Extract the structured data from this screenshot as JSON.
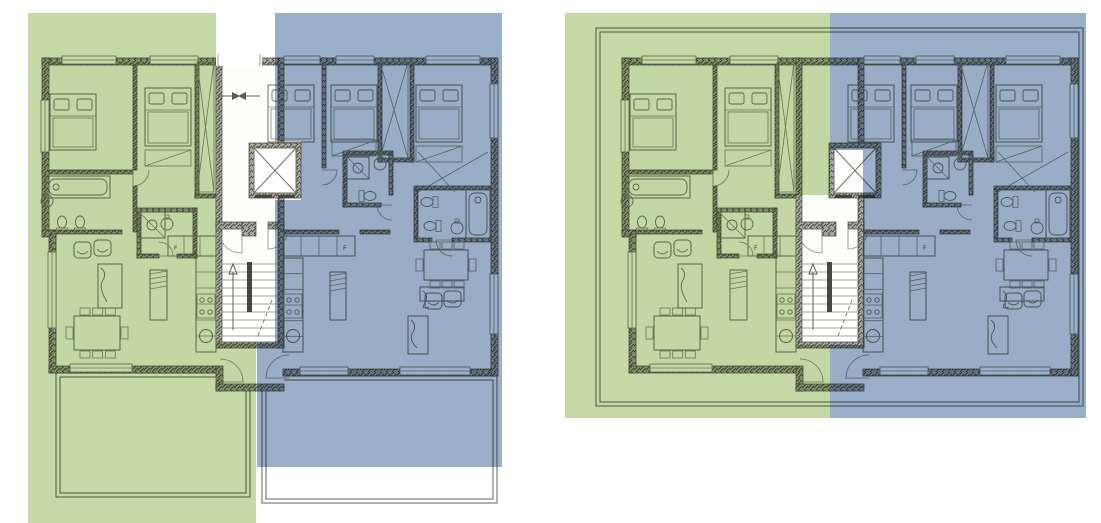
{
  "meta": {
    "description": "Two apartment floor plans side by side: ground floor with garden terraces and upper floor with roof outline. Each plan split into a green unit (left) and a blue unit (right) around a central stair and elevator core.",
    "canvas": {
      "w": 1101,
      "h": 523
    }
  },
  "colors": {
    "unit_a_green": "#c5d9a6",
    "unit_b_blue": "#9aafc9",
    "paper": "#ffffff",
    "floor_fill": "#fdfdfc",
    "wall_hatch_bg": "#b2b2ab",
    "wall_hatch_line": "#51534c",
    "wall_stroke": "#45473f",
    "line": "#71756a",
    "thin_line": "#868a7e",
    "outline": "#62665b",
    "arrow": "#5a5d53"
  },
  "panels": [
    {
      "name": "ground-floor-plan",
      "dx": 0,
      "features": {
        "terraces": true,
        "roof": false,
        "corridor": true
      },
      "overlays": [
        {
          "unit": "unit-a-highlight",
          "color": "unit_a_green",
          "points": [
            [
              28,
              13
            ],
            [
              216,
              13
            ],
            [
              216,
              343
            ],
            [
              256,
              343
            ],
            [
              256,
              523
            ],
            [
              28,
              523
            ]
          ]
        },
        {
          "unit": "unit-b-highlight",
          "color": "unit_b_blue",
          "points": [
            [
              275,
              13
            ],
            [
              502,
              13
            ],
            [
              502,
              467
            ],
            [
              257,
              467
            ],
            [
              257,
              343
            ],
            [
              275,
              343
            ],
            [
              275,
              200
            ],
            [
              301,
              200
            ],
            [
              301,
              141
            ],
            [
              275,
              141
            ]
          ]
        }
      ]
    },
    {
      "name": "upper-floor-plan",
      "dx": 580,
      "features": {
        "terraces": false,
        "roof": true,
        "corridor": false
      },
      "overlays": [
        {
          "unit": "unit-a-highlight",
          "color": "unit_a_green",
          "points": [
            [
              565,
              13
            ],
            [
              830,
              13
            ],
            [
              830,
              195
            ],
            [
              796,
              195
            ],
            [
              796,
              345
            ],
            [
              830,
              345
            ],
            [
              830,
              418
            ],
            [
              565,
              418
            ]
          ]
        },
        {
          "unit": "unit-b-highlight",
          "color": "unit_b_blue",
          "points": [
            [
              830,
              13
            ],
            [
              1086,
              13
            ],
            [
              1086,
              418
            ],
            [
              830,
              418
            ],
            [
              830,
              345
            ],
            [
              863,
              345
            ],
            [
              863,
              150
            ],
            [
              830,
              150
            ]
          ]
        }
      ]
    }
  ],
  "plan": {
    "footprint": "M42,58 H497 V376 H284 V391 H216 V373 H49 V234 H42 Z",
    "walls": [
      [
        42,
        58,
        455,
        7
      ],
      [
        42,
        58,
        7,
        176
      ],
      [
        42,
        230,
        14,
        7
      ],
      [
        49,
        234,
        7,
        139
      ],
      [
        49,
        366,
        168,
        7
      ],
      [
        216,
        366,
        7,
        25
      ],
      [
        216,
        384,
        68,
        7
      ],
      [
        283,
        369,
        214,
        7
      ],
      [
        491,
        58,
        7,
        318
      ],
      [
        216,
        58,
        6,
        290
      ],
      [
        278,
        58,
        6,
        290
      ],
      [
        216,
        342,
        68,
        6
      ],
      [
        216,
        222,
        26,
        7
      ],
      [
        242,
        222,
        14,
        14
      ],
      [
        268,
        222,
        16,
        7
      ]
    ],
    "partitions": [
      [
        133,
        58,
        4,
        112
      ],
      [
        133,
        186,
        4,
        46
      ],
      [
        195,
        58,
        4,
        140
      ],
      [
        195,
        194,
        21,
        4
      ],
      [
        42,
        170,
        91,
        4
      ],
      [
        42,
        230,
        80,
        4
      ],
      [
        137,
        208,
        60,
        4
      ],
      [
        137,
        212,
        4,
        46
      ],
      [
        193,
        208,
        4,
        50
      ],
      [
        137,
        254,
        22,
        4
      ],
      [
        177,
        254,
        20,
        4
      ],
      [
        322,
        58,
        4,
        110
      ],
      [
        378,
        58,
        4,
        104
      ],
      [
        410,
        58,
        4,
        104
      ],
      [
        378,
        158,
        36,
        4
      ],
      [
        343,
        151,
        50,
        4
      ],
      [
        343,
        155,
        4,
        52
      ],
      [
        389,
        155,
        4,
        40
      ],
      [
        343,
        203,
        38,
        4
      ],
      [
        414,
        186,
        76,
        4
      ],
      [
        414,
        190,
        4,
        48
      ],
      [
        414,
        238,
        18,
        4
      ],
      [
        452,
        238,
        39,
        4
      ],
      [
        283,
        230,
        56,
        4
      ],
      [
        360,
        230,
        30,
        4
      ]
    ],
    "windows": [
      [
        62,
        56,
        54,
        8
      ],
      [
        150,
        56,
        48,
        8
      ],
      [
        284,
        56,
        36,
        8
      ],
      [
        336,
        56,
        38,
        8
      ],
      [
        426,
        56,
        54,
        8
      ],
      [
        41,
        100,
        8,
        52
      ],
      [
        48,
        252,
        8,
        76
      ],
      [
        70,
        364,
        62,
        8
      ],
      [
        300,
        367,
        48,
        8
      ],
      [
        400,
        367,
        70,
        8
      ],
      [
        490,
        84,
        8,
        54
      ],
      [
        490,
        274,
        8,
        60
      ]
    ],
    "beds": [
      {
        "x": 50,
        "y": 94,
        "w": 46,
        "h": 56
      },
      {
        "x": 145,
        "y": 88,
        "w": 46,
        "h": 58
      },
      {
        "x": 268,
        "y": 85,
        "w": 46,
        "h": 57
      },
      {
        "x": 331,
        "y": 85,
        "w": 46,
        "h": 57
      },
      {
        "x": 416,
        "y": 85,
        "w": 46,
        "h": 57
      }
    ],
    "tubs": [
      {
        "x": 46,
        "y": 176,
        "w": 64,
        "h": 22
      },
      {
        "x": 466,
        "y": 190,
        "w": 24,
        "h": 48
      }
    ],
    "showers": [
      {
        "x": 139,
        "y": 212,
        "w": 26,
        "h": 26
      },
      {
        "x": 347,
        "y": 157,
        "w": 22,
        "h": 22
      }
    ],
    "toilets": [
      {
        "cx": 62,
        "cy": 222,
        "rot": 180
      },
      {
        "cx": 80,
        "cy": 222,
        "rot": 180
      },
      {
        "cx": 370,
        "cy": 196,
        "rot": -90
      },
      {
        "cx": 427,
        "cy": 202,
        "rot": 90
      },
      {
        "cx": 430,
        "cy": 226,
        "rot": 90
      }
    ],
    "sinks": [
      {
        "cx": 47,
        "cy": 201
      },
      {
        "cx": 167,
        "cy": 224
      },
      {
        "cx": 380,
        "cy": 164
      },
      {
        "cx": 457,
        "cy": 228
      }
    ],
    "kitchens": [
      {
        "label": "F",
        "topRow": {
          "x": 168,
          "y": 236,
          "w": 48,
          "h": 20,
          "cells": 3
        },
        "labelPos": {
          "x": 174,
          "y": 250
        },
        "run": {
          "x": 196,
          "y": 256,
          "w": 20,
          "h": 96,
          "cells": 6
        },
        "cooktop": {
          "x": 197,
          "y": 294,
          "w": 18,
          "h": 24
        },
        "sink": {
          "cx": 206,
          "cy": 336
        },
        "island": {
          "x": 150,
          "y": 270,
          "w": 17,
          "h": 50
        }
      },
      {
        "label": "F",
        "topRow": {
          "x": 283,
          "y": 236,
          "w": 72,
          "h": 20,
          "cells": 4
        },
        "labelPos": {
          "x": 343,
          "y": 250
        },
        "run": {
          "x": 283,
          "y": 258,
          "w": 20,
          "h": 94,
          "cells": 6
        },
        "cooktop": {
          "x": 284,
          "y": 294,
          "w": 18,
          "h": 24
        },
        "sink": {
          "cx": 293,
          "cy": 336
        },
        "island": {
          "x": 330,
          "y": 272,
          "w": 16,
          "h": 48
        }
      }
    ],
    "tables": [
      {
        "x": 74,
        "y": 316,
        "w": 46,
        "h": 34
      },
      {
        "x": 424,
        "y": 250,
        "w": 44,
        "h": 30
      }
    ],
    "consoles": [
      {
        "x": 98,
        "y": 264,
        "w": 24,
        "h": 44
      },
      {
        "x": 420,
        "y": 287,
        "w": 44,
        "h": 14
      },
      {
        "x": 408,
        "y": 316,
        "w": 20,
        "h": 38
      }
    ],
    "armchairs": [
      {
        "x": 74,
        "y": 242
      },
      {
        "x": 94,
        "y": 240
      },
      {
        "x": 425,
        "y": 293
      },
      {
        "x": 444,
        "y": 291
      }
    ],
    "closets": [
      {
        "x": 197,
        "y": 62,
        "w": 17,
        "h": 130
      },
      {
        "x": 380,
        "y": 62,
        "w": 28,
        "h": 96
      }
    ],
    "wardrobes": [
      {
        "x": 145,
        "y": 150,
        "w": 46,
        "h": 16
      },
      {
        "x": 332,
        "y": 140,
        "w": 44,
        "h": 16
      },
      {
        "x": 416,
        "y": 146,
        "w": 46,
        "h": 16
      }
    ],
    "closetDiagonals": [
      [
        418,
        192,
        488,
        152
      ],
      [
        418,
        152,
        455,
        192
      ]
    ],
    "stairs": {
      "x": 222,
      "y": 232,
      "w": 55,
      "h": 108,
      "treadTop": 264,
      "treadBottom": 336,
      "treadStep": 8,
      "bar": {
        "x": 247,
        "y": 262,
        "w": 5,
        "h": 50
      },
      "arrow": {
        "x": 233,
        "y1": 330,
        "y2": 272
      },
      "dashed": [
        258,
        336,
        272,
        300
      ]
    },
    "elevator": {
      "x": 249,
      "y": 143,
      "w": 52,
      "h": 55
    },
    "doors": [
      {
        "hx": 242,
        "hy": 229,
        "r": 24,
        "a0": 90,
        "a1": 180,
        "sweep": 1
      },
      {
        "hx": 268,
        "hy": 229,
        "r": 20,
        "a0": 90,
        "a1": 0,
        "sweep": 0
      },
      {
        "hx": 220,
        "hy": 382,
        "r": 23,
        "a0": 0,
        "a1": 270,
        "sweep": 0
      },
      {
        "hx": 289,
        "hy": 378,
        "r": 23,
        "a0": 180,
        "a1": 270,
        "sweep": 1
      },
      {
        "hx": 133,
        "hy": 170,
        "r": 16,
        "a0": 90,
        "a1": 0,
        "sweep": 0
      },
      {
        "hx": 159,
        "hy": 256,
        "r": 14,
        "a0": 0,
        "a1": 270,
        "sweep": 0
      },
      {
        "hx": 392,
        "hy": 205,
        "r": 15,
        "a0": 180,
        "a1": 90,
        "sweep": 0
      },
      {
        "hx": 452,
        "hy": 240,
        "r": 16,
        "a0": 180,
        "a1": 90,
        "sweep": 0
      },
      {
        "hx": 322,
        "hy": 170,
        "r": 15,
        "a0": 0,
        "a1": 90,
        "sweep": 1
      }
    ],
    "corridor": {
      "gap": {
        "x": 216,
        "y": 54,
        "w": 46,
        "h": 12
      },
      "marker": {
        "y": 96,
        "x1": 218,
        "x2": 260
      }
    },
    "terraces": [
      [
        56,
        373,
        194,
        124
      ],
      [
        60,
        377,
        186,
        116
      ],
      [
        262,
        376,
        235,
        127
      ],
      [
        266,
        380,
        227,
        119
      ]
    ],
    "roof": [
      [
        16,
        28,
        487,
        378
      ],
      [
        20,
        32,
        479,
        370
      ]
    ]
  }
}
